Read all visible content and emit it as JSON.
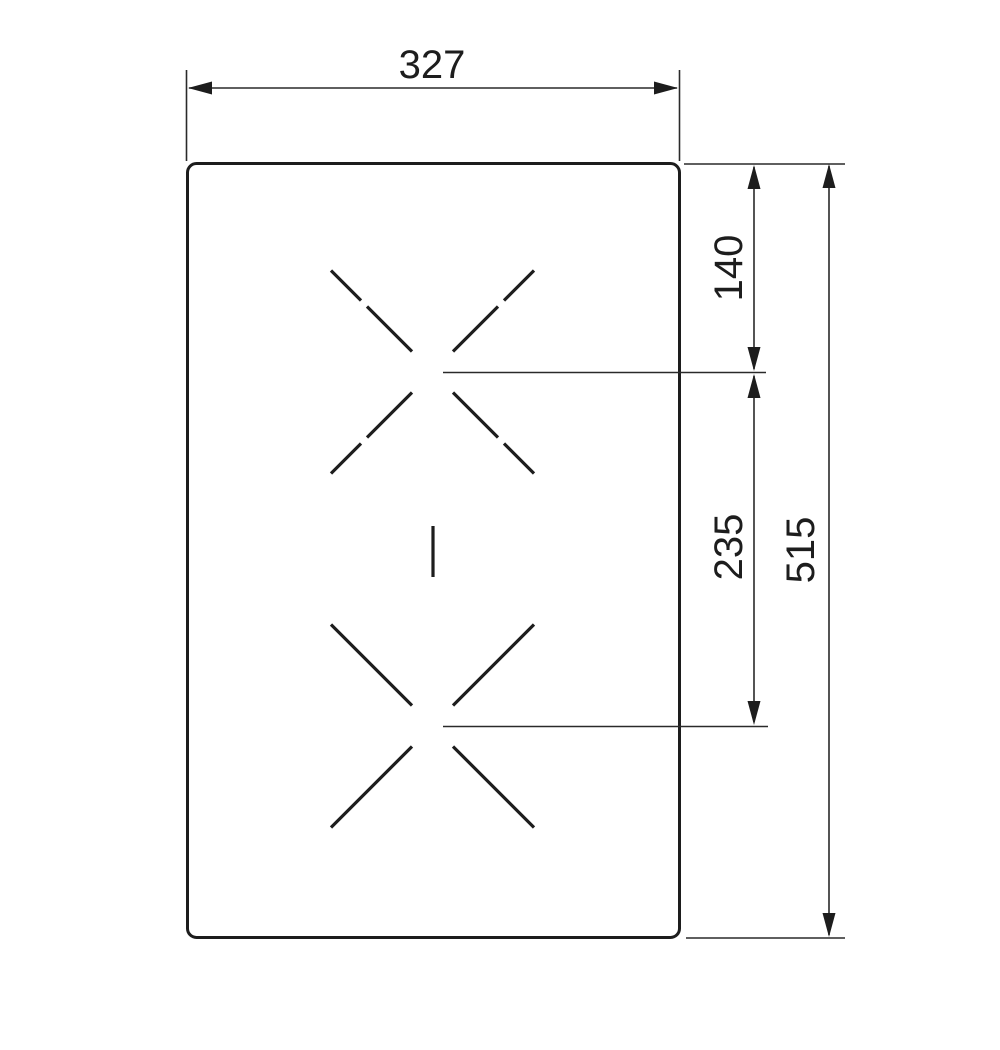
{
  "diagram": {
    "type": "installation-dimension-drawing",
    "background_color": "#ffffff",
    "line_color": "#1d1d1d",
    "panel": {
      "shape": "rounded-rectangle",
      "width_label": "327",
      "height_label": "515"
    },
    "dimensions": {
      "width": {
        "label": "327"
      },
      "zone_offset_top": {
        "label": "140"
      },
      "zone_spacing": {
        "label": "235"
      },
      "height_total": {
        "label": "515"
      }
    },
    "markers": {
      "zone_top": "cross-mark-dashed",
      "zone_bottom": "cross-mark-solid",
      "center_divider": "short-vertical-line"
    }
  }
}
